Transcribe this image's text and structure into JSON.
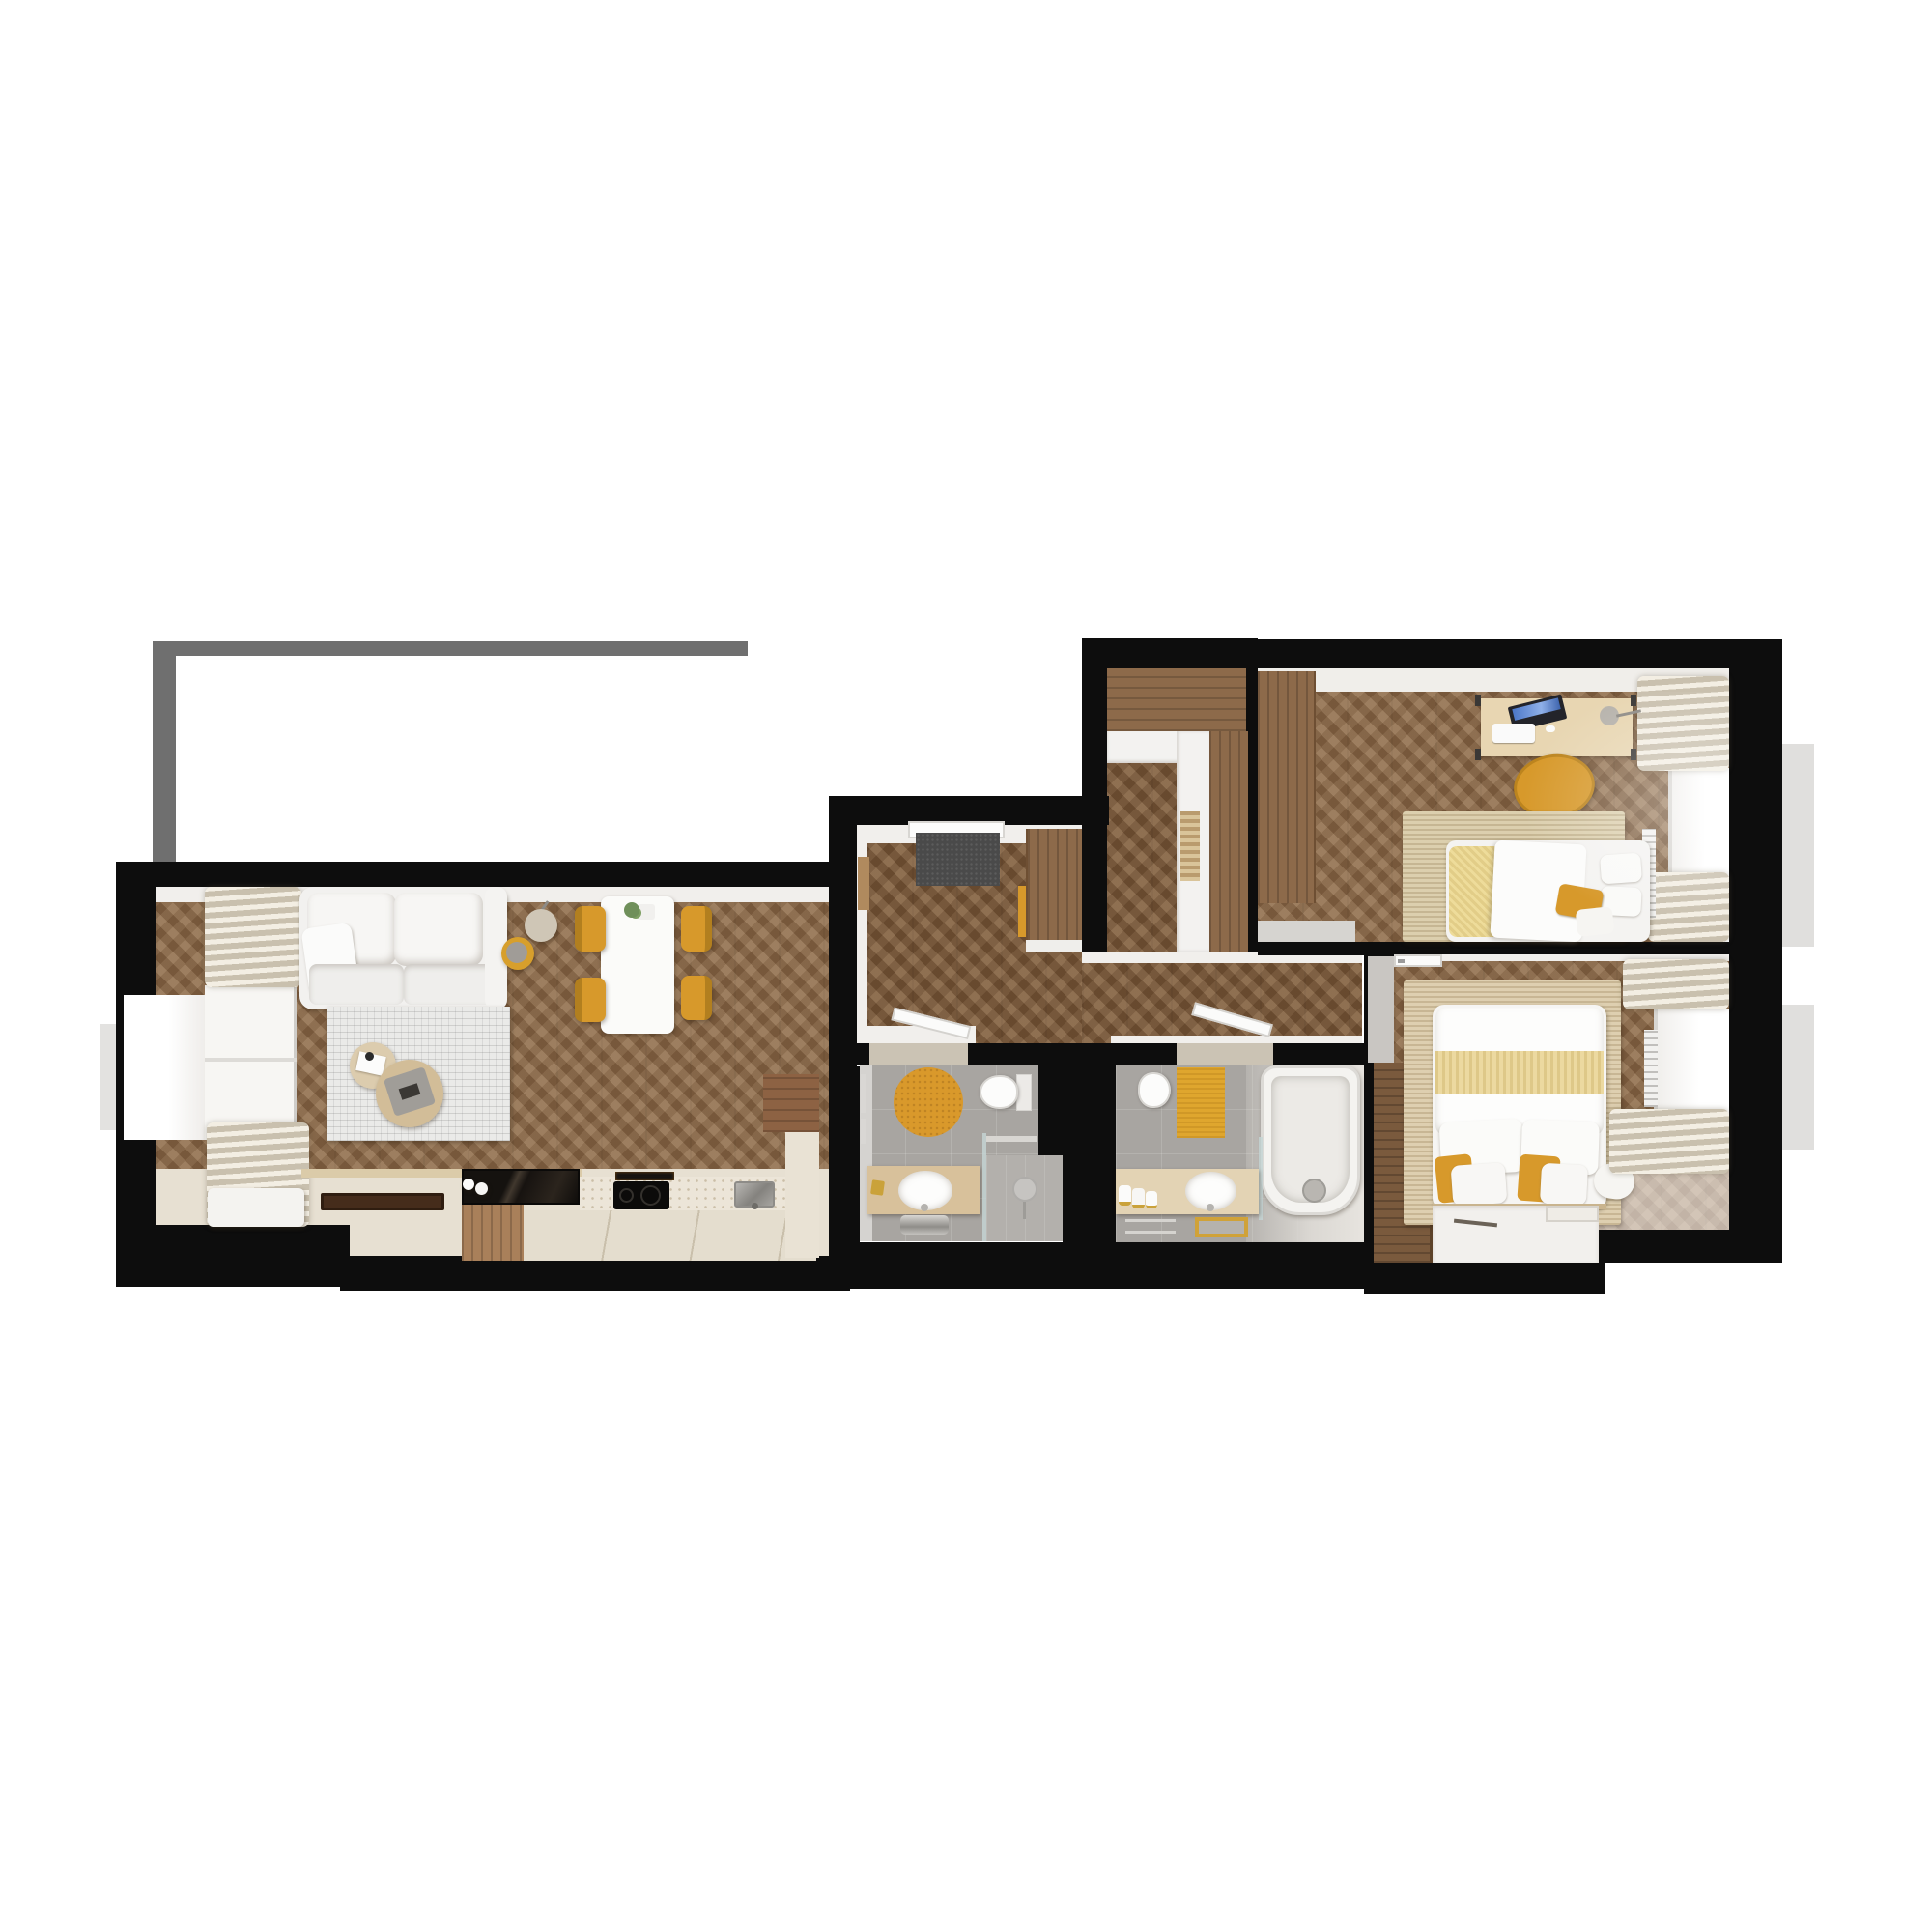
{
  "document": {
    "kind": "apartment-floor-plan-3d-render",
    "view": "top-down",
    "background": "#ffffff",
    "visible_text": "none"
  },
  "palette": {
    "wall_black": "#0d0d0d",
    "balcony_outline_gray": "#6f6f6f",
    "wood_floor": "#8a6848",
    "wood_floor_hall": "#7c5a3b",
    "cabinet_wood": "#8d6a4a",
    "accent_mustard": "#d7992b",
    "accent_yellow_pale": "#ecd9a0",
    "textile_white": "#f2f1ef",
    "curtain_beige": "#d9d1c0",
    "rug_grid_gray": "#eaeae8",
    "rug_jute": "#dccfae",
    "bath_tile_gray": "#a8a5a1",
    "counter_stone": "#ece5d8",
    "glass_dark": "#1e1b18",
    "window_glow": "#ffffff"
  },
  "rooms": [
    {
      "id": "living-kitchen",
      "label": "Open living room with kitchen",
      "furniture": [
        "sofa",
        "throw-pillow",
        "grid-area-rug",
        "round-coffee-table-small",
        "round-coffee-table-large",
        "serving-tray",
        "floor-lamp",
        "yellow-side-stool",
        "dining-table",
        "potted-plant",
        "dining-chair-1",
        "dining-chair-2",
        "dining-chair-3",
        "dining-chair-4",
        "window-bench",
        "breakfast-tray",
        "curtains",
        "window",
        "glass-top-island",
        "island-cabinet",
        "extractor-vent",
        "induction-hob",
        "kitchen-sink",
        "stone-counter",
        "tall-kitchen-cabinet",
        "salt-pepper-jars",
        "wall-console"
      ]
    },
    {
      "id": "entry-hall",
      "label": "Entry hall",
      "furniture": [
        "front-door",
        "entry-doormat",
        "wardrobe",
        "mustard-accent-panel",
        "slim-wall-console"
      ]
    },
    {
      "id": "hall-closet",
      "label": "Hallway closet nook",
      "furniture": [
        "built-in-wardrobe-band",
        "white-storage-column",
        "wood-storage-column",
        "slatted-shelf"
      ]
    },
    {
      "id": "corridor",
      "label": "Corridor",
      "furniture": [
        "open-door-to-bathroom-1",
        "open-door-to-bathroom-2",
        "open-door-to-bedroom-2"
      ]
    },
    {
      "id": "bedroom-1",
      "label": "Bedroom with desk",
      "furniture": [
        "built-in-wardrobe",
        "desk",
        "laptop",
        "keyboard",
        "mouse",
        "desk-lamp",
        "mustard-swivel-chair",
        "jute-rug",
        "single-bed",
        "yellow-blanket",
        "duvet",
        "pillows",
        "mustard-cushion",
        "curtains",
        "window",
        "radiator"
      ]
    },
    {
      "id": "bedroom-2",
      "label": "Main bedroom",
      "furniture": [
        "door-frame",
        "built-in-wardrobe",
        "jute-rug",
        "double-bed",
        "duvet",
        "yellow-throw-band",
        "pillows",
        "mustard-cushions",
        "bolster-pillow",
        "vanity-shelf",
        "pen",
        "tablet",
        "curtains",
        "window",
        "radiator"
      ]
    },
    {
      "id": "bathroom-1",
      "label": "Shower bathroom",
      "furniture": [
        "round-yellow-rug",
        "toilet",
        "wood-vanity",
        "oval-sink",
        "chrome-siphon",
        "gold-faucet",
        "towel-rails",
        "glass-shower-screen",
        "shower-floor",
        "round-shower-mirror"
      ]
    },
    {
      "id": "bathroom-2",
      "label": "Bathtub bathroom",
      "furniture": [
        "toilet",
        "yellow-bath-mat",
        "wood-vanity",
        "oval-sink",
        "gold-framed-mirror",
        "towel-rolls",
        "towel-rack",
        "bathtub",
        "glass-screen",
        "shower-head"
      ]
    },
    {
      "id": "balcony",
      "label": "Balcony outline",
      "furniture": [
        "railing-outline"
      ]
    }
  ]
}
